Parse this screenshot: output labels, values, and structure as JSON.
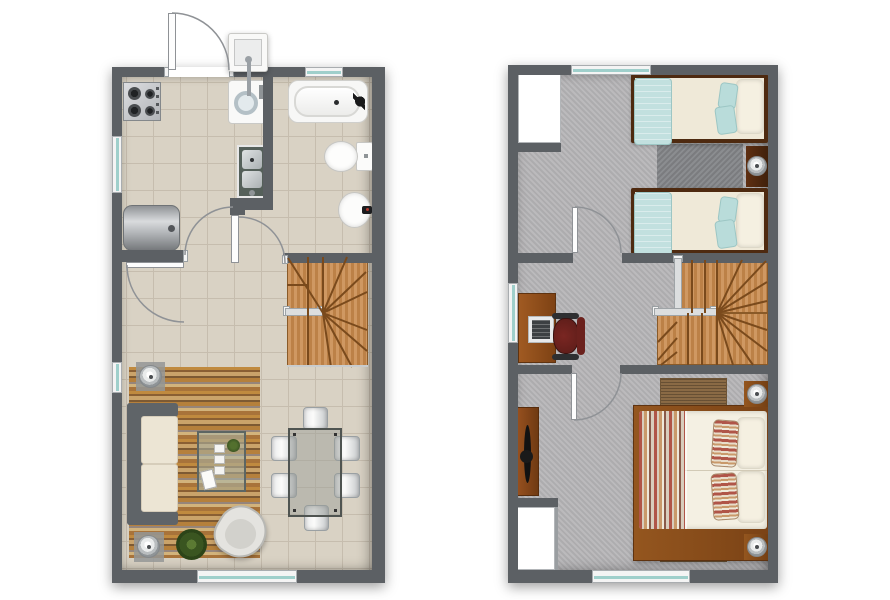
{
  "page": {
    "background": "#ffffff",
    "content_type": "two-storey house floor plan, top-down view, no text labels"
  },
  "palette": {
    "wall": "#5c6064",
    "tile": "#d9d2c4",
    "tile_line": "#c6bdae",
    "carpet": "#b6b5b7",
    "rug_dark": "#85878a",
    "stair_wood": "#c8894b",
    "stair_line": "#7a4a1c",
    "railing": "#dcdedf",
    "window_glass": "#9fcfcb",
    "window_frame": "#f4f4f4",
    "bed_wood_dark": "#4e2a10",
    "mattress": "#efe9d8",
    "blanket_blue": "#c2e0df",
    "pillow_white": "#f5f0e1",
    "bed_wood": "#8a4f1f",
    "rug_brown": "#8a6a45",
    "stripe_red": "#b05548",
    "stripe_tan": "#c9996a",
    "sofa_frame": "#5f6468",
    "sofa_cushion": "#ece5d4",
    "glass": "#aab6ac",
    "arc": "#8f9296",
    "chair_red": "#6f221d",
    "plant_green": "#3a5520"
  },
  "floor_plans": [
    {
      "id": "first-floor",
      "rooms": [
        "kitchen",
        "bathroom",
        "hallway",
        "living-dining-room"
      ],
      "fixtures": [
        "entry-door",
        "exterior-laundry-sink",
        "washing-machine",
        "gas-stove",
        "kitchen-sink",
        "water-heater",
        "bathtub",
        "toilet",
        "pedestal-sink",
        "winder-staircase",
        "sofa",
        "area-rug",
        "coffee-table",
        "armchair",
        "side-table-lamp",
        "side-table-lamp",
        "dining-table",
        "dining-chair",
        "plant",
        "window"
      ]
    },
    {
      "id": "second-floor",
      "rooms": [
        "bedroom-1",
        "study-hall",
        "master-bedroom"
      ],
      "fixtures": [
        "closet",
        "twin-bed",
        "twin-bed",
        "nightstand-lamp",
        "bedside-rug",
        "desk",
        "monitor",
        "office-chair",
        "winder-staircase",
        "double-bed",
        "nightstand-lamp",
        "nightstand-lamp",
        "bedside-rug",
        "bedside-rug",
        "dresser",
        "closet",
        "window"
      ]
    }
  ]
}
